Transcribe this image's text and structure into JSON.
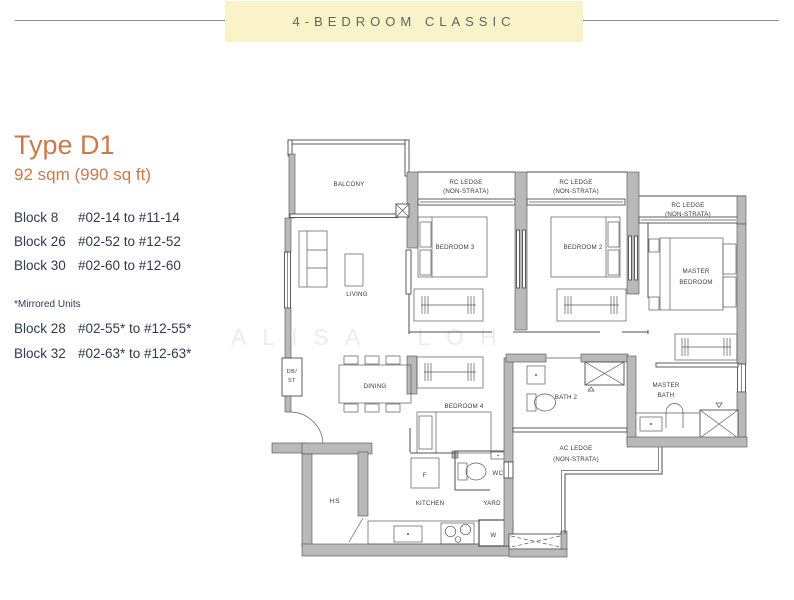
{
  "banner": {
    "title": "4-BEDROOM CLASSIC"
  },
  "info": {
    "type": "Type D1",
    "area": "92 sqm (990 sq ft)",
    "blocks": [
      {
        "name": "Block 8",
        "range": "#02-14 to #11-14"
      },
      {
        "name": "Block 26",
        "range": "#02-52 to #12-52"
      },
      {
        "name": "Block 30",
        "range": "#02-60 to #12-60"
      }
    ],
    "mirrored_note": "*Mirrored Units",
    "mirrored_blocks": [
      {
        "name": "Block 28",
        "range": "#02-55* to #12-55*"
      },
      {
        "name": "Block 32",
        "range": "#02-63* to #12-63*"
      }
    ]
  },
  "watermark": "ALISA LOH",
  "plan": {
    "labels": {
      "balcony": "BALCONY",
      "living": "LIVING",
      "dining": "DINING",
      "bedroom3": "BEDROOM 3",
      "bedroom2": "BEDROOM 2",
      "bedroom4": "BEDROOM 4",
      "master_l1": "MASTER",
      "master_l2": "BEDROOM",
      "bath2": "BATH 2",
      "mbath_l1": "MASTER",
      "mbath_l2": "BATH",
      "kitchen": "KITCHEN",
      "yard": "YARD",
      "wc": "WC",
      "hs": "HS",
      "db": "DB/",
      "st": "ST",
      "fridge": "F",
      "washer": "W"
    },
    "ledges": {
      "rc1": "RC LEDGE",
      "rc2": "(NON-STRATA)",
      "ac1": "AC LEDGE",
      "ac2": "(NON-STRATA)"
    },
    "colors": {
      "accent": "#c97a4c",
      "banner_bg": "#faf3c7",
      "wall_gray": "#b9b9b9",
      "line": "#4d4d4d",
      "text_dark": "#2f3c4e"
    }
  }
}
